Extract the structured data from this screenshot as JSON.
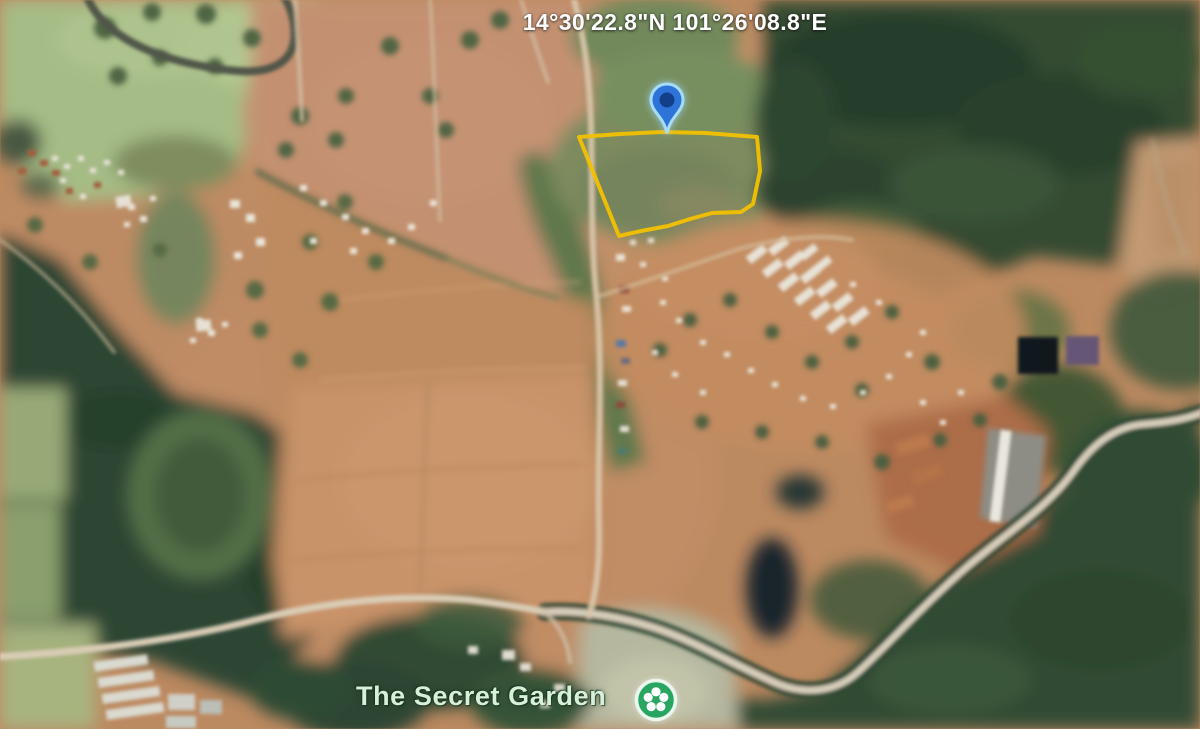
{
  "map": {
    "coordinates_label": "14°30'22.8\"N 101°26'08.8\"E",
    "place": {
      "label": "The Secret Garden"
    },
    "parcel": {
      "points": "579,137 620,134 662,132 706,133 757,137 760,171 753,204 741,212 712,213 690,219 668,226 641,231 619,236",
      "stroke_color": "#F2C100"
    },
    "pin": {
      "fill": "#2D74D9",
      "core": "#123F87",
      "halo": "#A6DCF7"
    },
    "poi": {
      "fill": "#28A661",
      "glyph": "#FFFFFF",
      "ring": "#EAF6EE"
    },
    "label_colors": {
      "place": "#D8EFD9",
      "coordinates": "#FFFFFF"
    }
  }
}
